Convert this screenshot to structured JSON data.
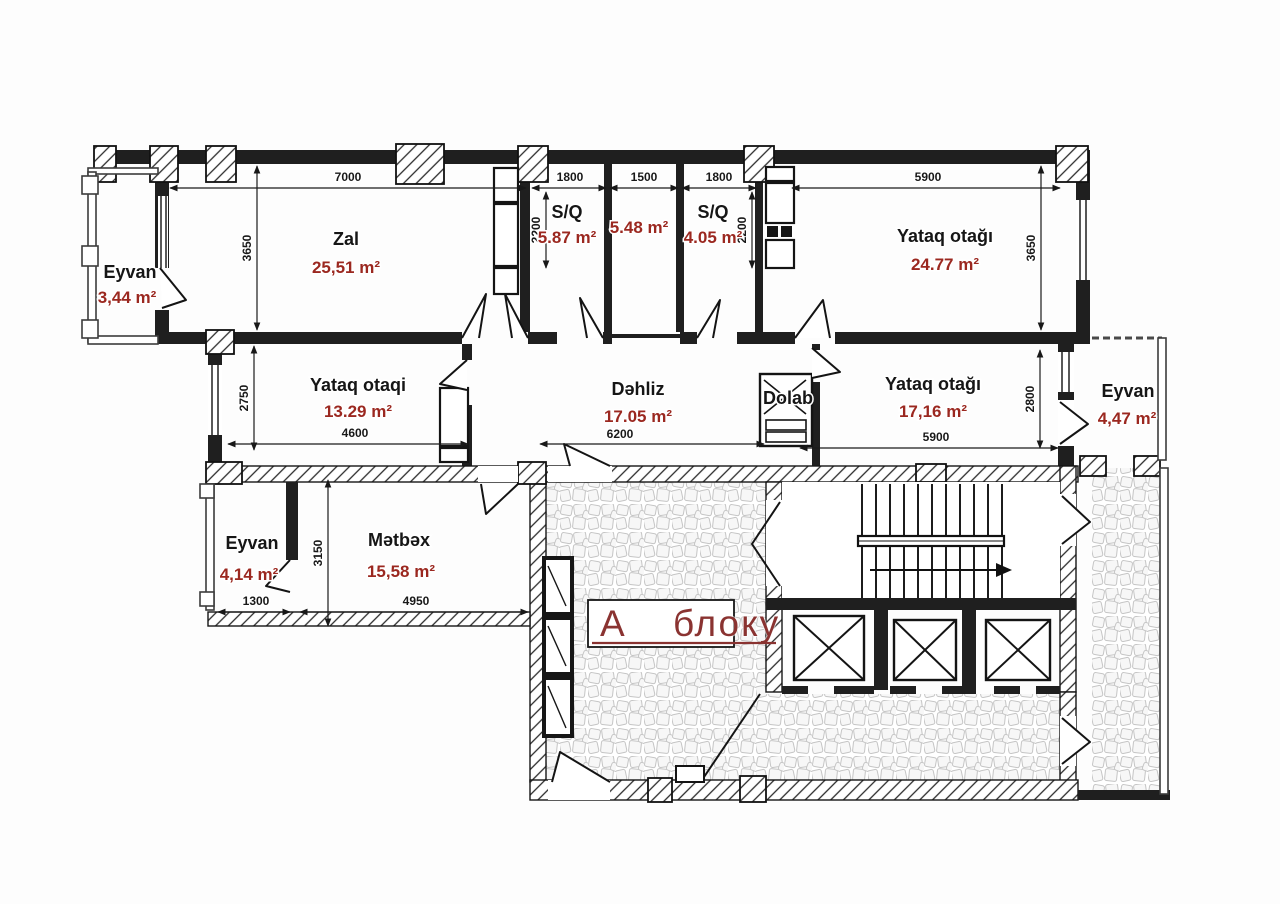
{
  "plan": {
    "block_label": "А блоку",
    "rooms": [
      {
        "name": "Eyvan",
        "area": "3,44 m²"
      },
      {
        "name": "Zal",
        "area": "25,51 m²"
      },
      {
        "name": "S/Q",
        "area": "5.87 m²"
      },
      {
        "name": "",
        "area": "5.48 m²"
      },
      {
        "name": "S/Q",
        "area": "4.05 m²"
      },
      {
        "name": "Yataq otağı",
        "area": "24.77 m²"
      },
      {
        "name": "Yataq otaqi",
        "area": "13.29 m²"
      },
      {
        "name": "Dəhliz",
        "area": "17.05 m²"
      },
      {
        "name": "Dolab",
        "area": ""
      },
      {
        "name": "Yataq otağı",
        "area": "17,16 m²"
      },
      {
        "name": "Eyvan",
        "area": "4,47 m²"
      },
      {
        "name": "Eyvan",
        "area": "4,14 m²"
      },
      {
        "name": "Mətbəx",
        "area": "15,58 m²"
      }
    ],
    "dimensions": {
      "top": [
        "7000",
        "1800",
        "1500",
        "1800",
        "5900"
      ],
      "verticals": [
        "3650",
        "2200",
        "2200",
        "3650",
        "2750",
        "2800",
        "3150"
      ],
      "middle": [
        "4600",
        "6200",
        "5900"
      ],
      "bottom": [
        "1300",
        "4950"
      ]
    },
    "colors": {
      "area_text": "#9b2820",
      "block_text": "#8a3331",
      "wall": "#1f1f1f"
    }
  }
}
